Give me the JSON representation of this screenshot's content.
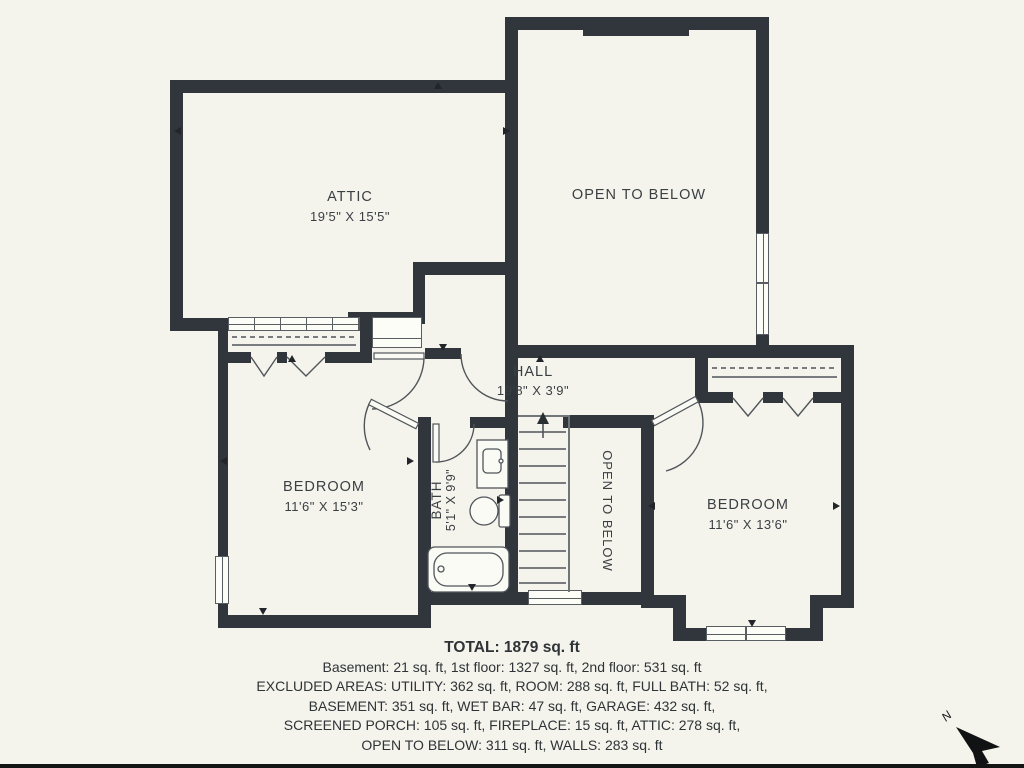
{
  "plan": {
    "rooms": {
      "attic": {
        "label": "ATTIC",
        "dims": "19'5\" X 15'5\""
      },
      "open_to_below_upper": {
        "label": "OPEN TO BELOW"
      },
      "hall": {
        "label": "HALL",
        "dims": "19'8\" X 3'9\""
      },
      "bedroom_left": {
        "label": "BEDROOM",
        "dims": "11'6\" X 15'3\""
      },
      "bath": {
        "label": "BATH",
        "dims": "5'1\" X 9'9\""
      },
      "open_to_below_stairwell": {
        "label": "OPEN TO BELOW"
      },
      "bedroom_right": {
        "label": "BEDROOM",
        "dims": "11'6\" X 13'6\""
      }
    },
    "compass_label": "N",
    "colors": {
      "wall": "#31363C",
      "background": "#F5F4EC",
      "linework": "#50555A",
      "text": "#3A3F44"
    }
  },
  "summary": {
    "total": "TOTAL: 1879 sq. ft",
    "lines": [
      "Basement: 21 sq. ft, 1st floor: 1327 sq. ft, 2nd floor: 531 sq. ft",
      "EXCLUDED AREAS: UTILITY: 362 sq. ft, ROOM: 288 sq. ft, FULL BATH: 52 sq. ft,",
      "BASEMENT: 351 sq. ft, WET BAR: 47 sq. ft, GARAGE: 432 sq. ft,",
      "SCREENED PORCH: 105 sq. ft, FIREPLACE: 15 sq. ft, ATTIC: 278 sq. ft,",
      "OPEN TO BELOW: 311 sq. ft, WALLS: 283 sq. ft"
    ]
  }
}
